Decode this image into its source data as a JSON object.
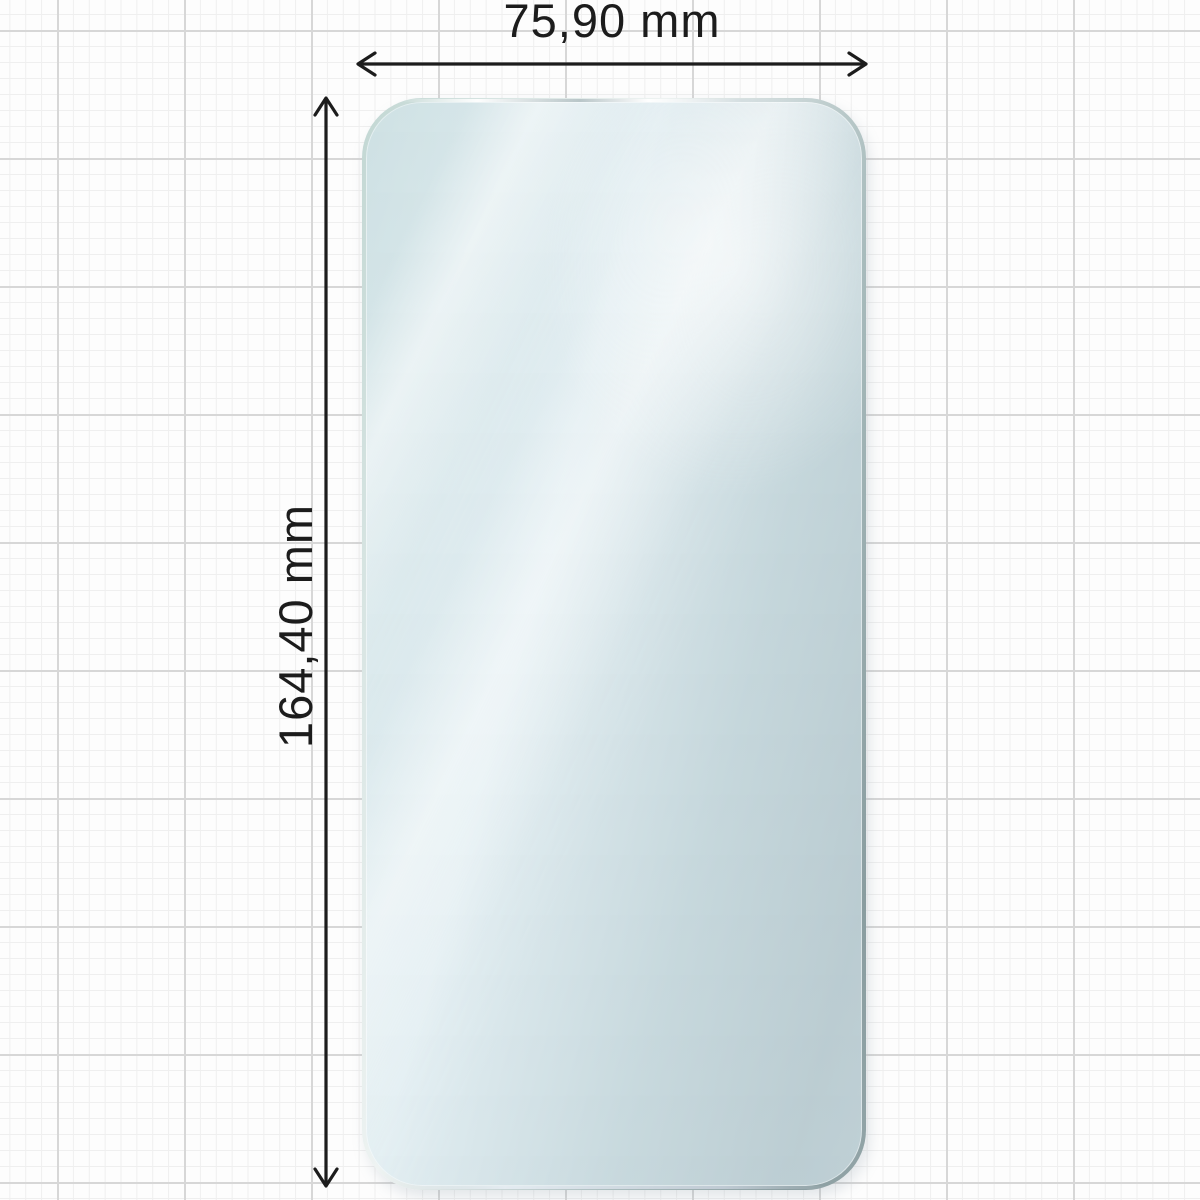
{
  "diagram": {
    "width_dimension": {
      "label": "75,90 mm",
      "arrow_icon": "double-headed-horizontal-arrow"
    },
    "height_dimension": {
      "label": "164,40 mm",
      "arrow_icon": "double-headed-vertical-arrow"
    },
    "dimension_line_color": "#1c1c1c",
    "object": {
      "kind": "screen-protector-film",
      "fill_color": "#e9f3f7",
      "edge_color_light": "#c2d7d3",
      "edge_color_dark": "#8a9da0"
    },
    "background": {
      "paper_color": "#fdfdfd",
      "grid_minor_color": "#efefef",
      "grid_major_color": "#d7d7d7"
    }
  }
}
